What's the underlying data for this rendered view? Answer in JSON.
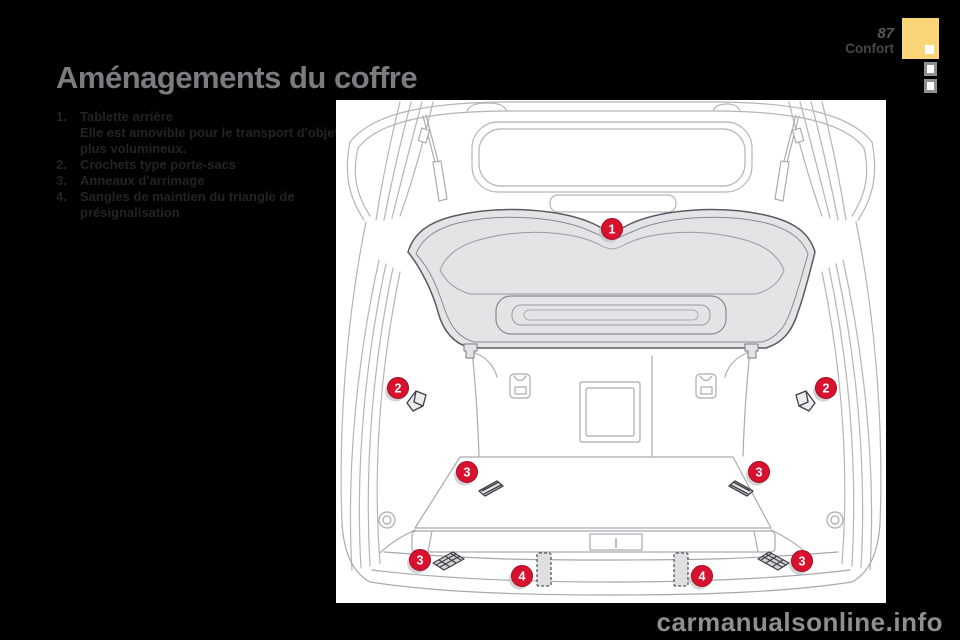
{
  "page": {
    "title": "Aménagements du coffre"
  },
  "header": {
    "page_number": "87",
    "section": "Confort"
  },
  "legend": {
    "items": [
      {
        "num": "1.",
        "label": "Tablette arrière",
        "description": "Elle est amovible pour le transport d'objets plus volumineux."
      },
      {
        "num": "2.",
        "label": "Crochets type porte-sacs",
        "description": ""
      },
      {
        "num": "3.",
        "label": "Anneaux d'arrimage",
        "description": ""
      },
      {
        "num": "4.",
        "label": "Sangles de maintien du triangle de présignalisation",
        "description": ""
      }
    ]
  },
  "diagram": {
    "markers": [
      {
        "label": "1"
      },
      {
        "label": "2"
      },
      {
        "label": "2"
      },
      {
        "label": "3"
      },
      {
        "label": "3"
      },
      {
        "label": "3"
      },
      {
        "label": "3"
      },
      {
        "label": "4"
      },
      {
        "label": "4"
      }
    ]
  },
  "footer": {
    "watermark": "carmanualsonline.info"
  },
  "colors": {
    "marker_red": "#d8112e",
    "marker_edge": "#a50d24",
    "tab_yellow": "#fbd679",
    "background": "#000000"
  }
}
